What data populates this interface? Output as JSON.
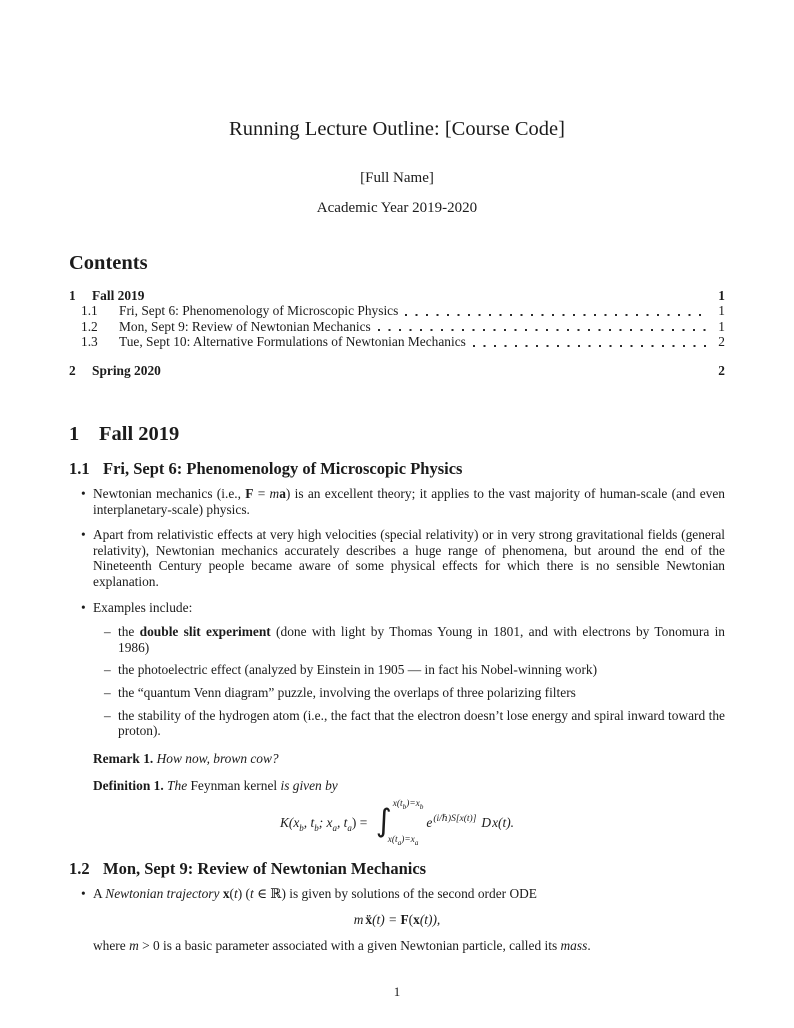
{
  "colors": {
    "text": "#1b1b1b",
    "page_background": "#ffffff"
  },
  "doc": {
    "title": "Running Lecture Outline: [Course Code]",
    "author": "[Full Name]",
    "date": "Academic Year 2019-2020",
    "page_number": "1"
  },
  "toc": {
    "heading": "Contents",
    "items": [
      {
        "num": "1",
        "label": "Fall 2019",
        "page": "1"
      },
      {
        "num": "1.1",
        "label": "Fri, Sept 6: Phenomenology of Microscopic Physics",
        "page": "1"
      },
      {
        "num": "1.2",
        "label": "Mon, Sept 9: Review of Newtonian Mechanics",
        "page": "1"
      },
      {
        "num": "1.3",
        "label": "Tue, Sept 10: Alternative Formulations of Newtonian Mechanics",
        "page": "2"
      },
      {
        "num": "2",
        "label": "Spring 2020",
        "page": "2"
      }
    ]
  },
  "sec1": {
    "num": "1",
    "title": "Fall 2019"
  },
  "sec11": {
    "num": "1.1",
    "title": "Fri, Sept 6: Phenomenology of Microscopic Physics",
    "b1": {
      "s1": "Newtonian mechanics (i.e., ",
      "F": "F",
      "eq": " = ",
      "m": "m",
      "a": "a",
      "s2": ") is an excellent theory; it applies to the vast majority of human-scale (and even interplanetary-scale) physics."
    },
    "b2": "Apart from relativistic effects at very high velocities (special relativity) or in very strong gravitational fields (general relativity), Newtonian mechanics accurately describes a huge range of phenomena, but around the end of the Nineteenth Century people became aware of some physical effects for which there is no sensible Newtonian explanation.",
    "b3": "Examples include:",
    "sub1": {
      "s1": "the ",
      "b": "double slit experiment",
      "s2": " (done with light by Thomas Young in 1801, and with electrons by Tonomura in 1986)"
    },
    "sub2": "the photoelectric effect (analyzed by Einstein in 1905 — in fact his Nobel-winning work)",
    "sub3": "the “quantum Venn diagram” puzzle, involving the overlaps of three polarizing filters",
    "sub4": "the stability of the hydrogen atom (i.e., the fact that the electron doesn’t lose energy and spiral inward toward the proton).",
    "remark": {
      "label": "Remark 1.",
      "text": "How now, brown cow?"
    },
    "definition": {
      "label": "Definition 1.",
      "s1": "The ",
      "term": "Feynman kernel",
      "s2": " is given by"
    },
    "formula": {
      "lhs": {
        "s1": "K(x",
        "b1": "b",
        "s2": ", t",
        "b2": "b",
        "s3": "; x",
        "a1": "a",
        "s4": ", t",
        "a2": "a",
        "s5": ") = "
      },
      "integral": "∫",
      "lim_top": {
        "s1": "x(t",
        "b1": "b",
        "s2": ")=x",
        "b2": "b"
      },
      "lim_bot": {
        "s1": "x(t",
        "a1": "a",
        "s2": ")=x",
        "a2": "a"
      },
      "e": "e",
      "exp": "(i/ℏ)S[x(t)]",
      "dsymbol": "D",
      "measure": "x(t)."
    }
  },
  "sec12": {
    "num": "1.2",
    "title": "Mon, Sept 9: Review of Newtonian Mechanics",
    "b1": {
      "s1": "A ",
      "traj": "Newtonian trajectory",
      "x": " x",
      "s2": "(",
      "t1": "t",
      "s3": ") (",
      "t2": "t",
      "s4": " ∈ ℝ) is given by solutions of the second order ODE"
    },
    "formula": {
      "m": "m",
      "xdd": "ẍ",
      "s1": "(t) = ",
      "F": "F",
      "s2": "(",
      "x": "x",
      "s3": "(t)),"
    },
    "closing": {
      "s1": "where ",
      "m": "m",
      "s2": " > 0 is a basic parameter associated with a given Newtonian particle, called its ",
      "mass": "mass",
      "s3": "."
    }
  }
}
